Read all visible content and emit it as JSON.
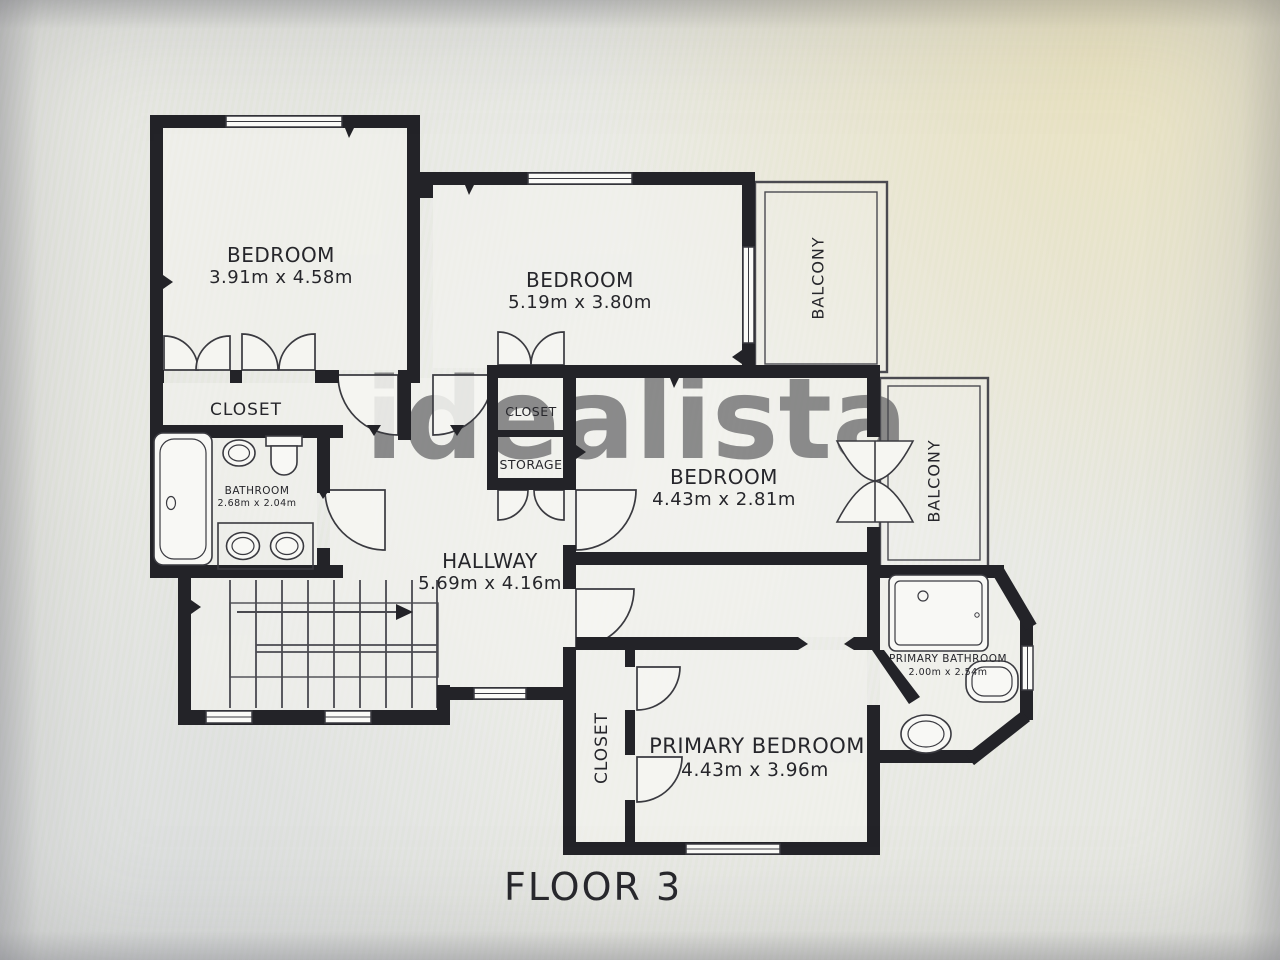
{
  "page": {
    "floor_label": "FLOOR 3",
    "watermark": "idealista"
  },
  "rooms": {
    "bedroom_top_left": {
      "name": "BEDROOM",
      "dims": "3.91m x 4.58m"
    },
    "bedroom_top_middle": {
      "name": "BEDROOM",
      "dims": "5.19m x 3.80m"
    },
    "bedroom_middle": {
      "name": "BEDROOM",
      "dims": "4.43m x 2.81m"
    },
    "primary_bedroom": {
      "name": "PRIMARY BEDROOM",
      "dims": "4.43m x 3.96m"
    },
    "hallway": {
      "name": "HALLWAY",
      "dims": "5.69m x 4.16m"
    },
    "bathroom": {
      "name": "BATHROOM",
      "dims": "2.68m x 2.04m"
    },
    "primary_bathroom": {
      "name": "PRIMARY BATHROOM",
      "dims": "2.00m x 2.54m"
    },
    "closet_bedroom1": {
      "name": "CLOSET"
    },
    "closet_center": {
      "name": "CLOSET"
    },
    "storage": {
      "name": "STORAGE"
    },
    "closet_primary": {
      "name": "CLOSET"
    },
    "balcony_top": {
      "name": "BALCONY"
    },
    "balcony_side": {
      "name": "BALCONY"
    }
  },
  "colors": {
    "wall": "#232328",
    "thin_line": "#4a4a50",
    "label_text": "#26262b",
    "watermark": "#8d8d8d",
    "paper": "#e9eae5",
    "room_fill": "#f3f3ef"
  }
}
